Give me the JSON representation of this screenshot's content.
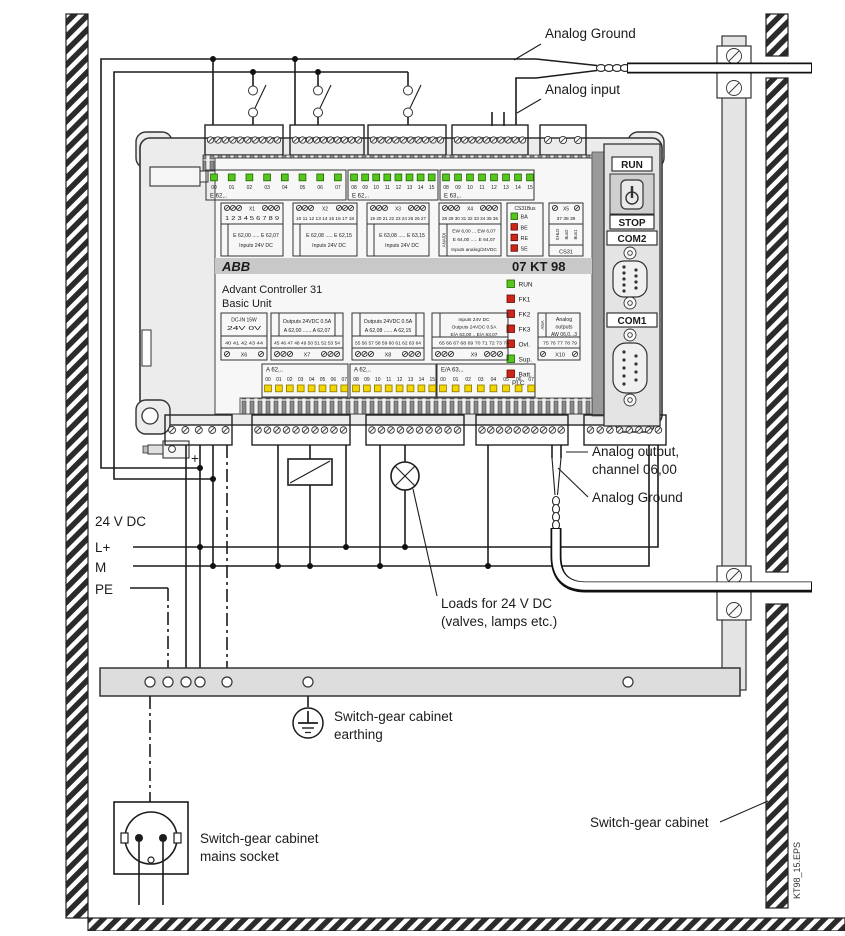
{
  "colors": {
    "led_green": "#55c71c",
    "led_red": "#cf2418",
    "led_yellow": "#f2d600",
    "abb_red": "#d2001e",
    "body_gray": "#ececec",
    "bar_gray": "#dddddd"
  },
  "labels": {
    "analog_ground_top": "Analog Ground",
    "analog_input": "Analog input",
    "supply": "24 V DC",
    "lplus": "L+",
    "m": "M",
    "pe": "PE",
    "plus": "+",
    "analog_output_1": "Analog output,",
    "analog_output_2": "channel 06,00",
    "analog_ground_bottom": "Analog Ground",
    "loads_1": "Loads for 24 V DC",
    "loads_2": "(valves, lamps etc.)",
    "earthing_1": "Switch-gear cabinet",
    "earthing_2": "earthing",
    "socket_1": "Switch-gear cabinet",
    "socket_2": "mains socket",
    "cabinet": "Switch-gear cabinet",
    "file_tag": "KT98_15.EPS"
  },
  "unit": {
    "brand": "ABB",
    "model": "07 KT 98",
    "product": "Advant Controller 31",
    "subtitle": "Basic Unit",
    "top_led_groups": [
      {
        "prefix": "E 62,..",
        "channels": [
          "00",
          "01",
          "02",
          "03",
          "04",
          "05",
          "06",
          "07"
        ]
      },
      {
        "prefix": "E 62,..",
        "channels": [
          "08",
          "09",
          "10",
          "11",
          "12",
          "13",
          "14",
          "15"
        ]
      },
      {
        "prefix": "E 63,..",
        "channels": [
          "08",
          "09",
          "10",
          "11",
          "12",
          "13",
          "14",
          "15"
        ]
      }
    ],
    "bottom_led_groups": [
      {
        "prefix": "A 62,..",
        "channels": [
          "00",
          "01",
          "02",
          "03",
          "04",
          "05",
          "06",
          "07"
        ]
      },
      {
        "prefix": "A 62,..",
        "channels": [
          "08",
          "09",
          "10",
          "11",
          "12",
          "13",
          "14",
          "15"
        ]
      },
      {
        "prefix": "E/A 63,..",
        "channels": [
          "00",
          "01",
          "02",
          "03",
          "04",
          "05",
          "06",
          "07"
        ]
      }
    ],
    "terminal_blocks_top": [
      {
        "id": "X1",
        "terminals": "1 2 3 4 5 6 7 8 9",
        "desc": [
          "E 62,00 ..... E 62,07",
          "Inputs 24V DC"
        ]
      },
      {
        "id": "X2",
        "terminals": "10 11 12 13 14 15 16 17 18",
        "desc": [
          "E 62,08 ..... E 62,15",
          "Inputs 24V DC"
        ]
      },
      {
        "id": "X3",
        "terminals": "19 20 21 22 23 24 25 26 27",
        "desc": [
          "E 63,08 ..... E 63,15",
          "Inputs 24V DC"
        ]
      },
      {
        "id": "X4",
        "terminals": "28 29 30 31 32 33 34 35 36",
        "side": "ANA/DI",
        "desc": [
          "EW 6,00 ... EW 6,07",
          "E 64,00 ..... E 64,07",
          "Inputs analog/24VDC"
        ]
      },
      {
        "id": "X5",
        "terminals": "37 38 39",
        "side": [
          "SHLD",
          "Bus2",
          "Bus1"
        ],
        "desc": [
          "CS31"
        ]
      }
    ],
    "cs31": {
      "title": "CS31Bus",
      "leds": [
        {
          "label": "BA",
          "color": "green"
        },
        {
          "label": "BE",
          "color": "red"
        },
        {
          "label": "RE",
          "color": "red"
        },
        {
          "label": "SE",
          "color": "red"
        }
      ]
    },
    "plc": {
      "label": "PLC",
      "leds": [
        {
          "label": "RUN",
          "color": "green"
        },
        {
          "label": "FK1",
          "color": "red"
        },
        {
          "label": "FK2",
          "color": "red"
        },
        {
          "label": "FK3",
          "color": "red"
        },
        {
          "label": "Ovl.",
          "color": "red"
        },
        {
          "label": "Sup.",
          "color": "green"
        },
        {
          "label": "Batt.",
          "color": "red"
        }
      ]
    },
    "terminal_blocks_bottom": [
      {
        "id": "X6",
        "desc": [
          "DC-IN 15W",
          "24V    0V"
        ],
        "terminals": "40 41 42 43 44"
      },
      {
        "id": "X7",
        "desc": [
          "Outputs 24VDC 0.5A",
          "A 62,00 ...... A 62,07"
        ],
        "terminals": "45 46 47 48 49 50 51 52 53 54"
      },
      {
        "id": "X8",
        "desc": [
          "Outputs 24VDC 0.5A",
          "A 62,08 ...... A 62,15"
        ],
        "terminals": "55 56 57 58 59 60 61 62 63 64"
      },
      {
        "id": "X9",
        "desc": [
          "Inputs 24V DC",
          "Outputs 24VDC 0.5A",
          "E/A 63,00 .. E/A 63,07"
        ],
        "terminals": "65 66 67 68 69 70 71 72 73 74"
      },
      {
        "id": "X10",
        "side": "ANA",
        "desc": [
          "Analog",
          "outputs",
          "AW 06,0...3"
        ],
        "terminals": "75 76 77 78 79"
      }
    ],
    "side_labels": {
      "run": "RUN",
      "stop": "STOP",
      "com2": "COM2",
      "com1": "COM1"
    }
  }
}
